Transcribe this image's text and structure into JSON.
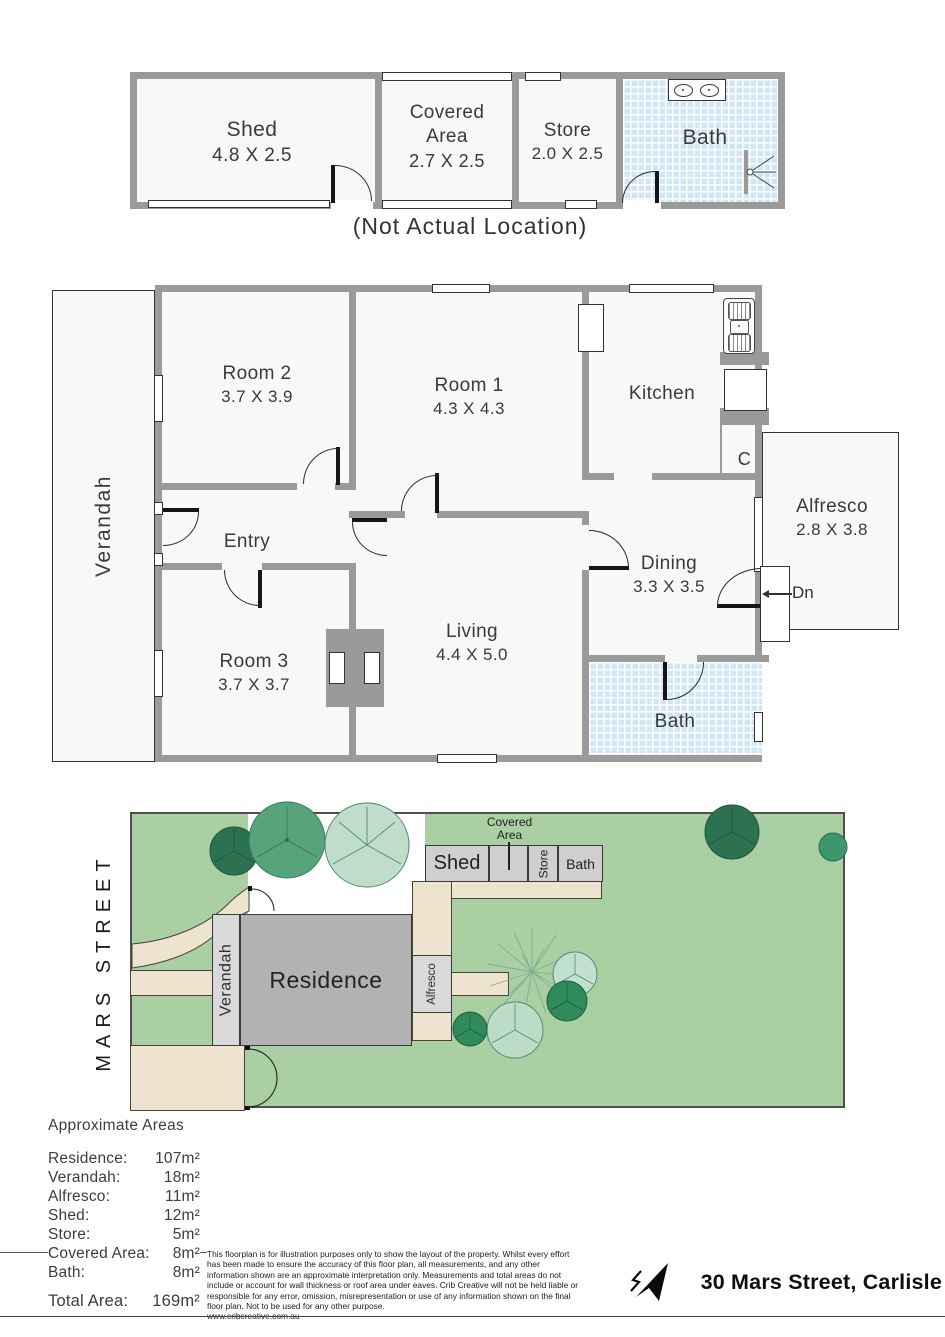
{
  "outbuilding": {
    "shed": {
      "name": "Shed",
      "dims": "4.8 X 2.5"
    },
    "covered": {
      "line1": "Covered",
      "line2": "Area",
      "dims": "2.7 X 2.5"
    },
    "store": {
      "name": "Store",
      "dims": "2.0 X 2.5"
    },
    "bath": {
      "name": "Bath"
    },
    "caption": "(Not Actual Location)"
  },
  "plan": {
    "verandah": "Verandah",
    "room2": {
      "name": "Room 2",
      "dims": "3.7 X 3.9"
    },
    "room1": {
      "name": "Room 1",
      "dims": "4.3 X 4.3"
    },
    "kitchen": {
      "name": "Kitchen"
    },
    "entry": {
      "name": "Entry"
    },
    "room3": {
      "name": "Room 3",
      "dims": "3.7 X 3.7"
    },
    "living": {
      "name": "Living",
      "dims": "4.4 X 5.0"
    },
    "dining": {
      "name": "Dining",
      "dims": "3.3 X 3.5"
    },
    "bath": {
      "name": "Bath"
    },
    "alfresco": {
      "name": "Alfresco",
      "dims": "2.8 X 3.8"
    },
    "cupboard": "C",
    "down": "Dn"
  },
  "site": {
    "street": "MARS STREET",
    "residence": "Residence",
    "verandah": "Verandah",
    "alfresco": "Alfresco",
    "shed": "Shed",
    "covered_line1": "Covered",
    "covered_line2": "Area",
    "store": "Store",
    "bath": "Bath"
  },
  "areas": {
    "title": "Approximate Areas",
    "items": [
      {
        "label": "Residence:",
        "value": "107m²"
      },
      {
        "label": "Verandah:",
        "value": "18m²"
      },
      {
        "label": "Alfresco:",
        "value": "11m²"
      },
      {
        "label": "Shed:",
        "value": "12m²"
      },
      {
        "label": "Store:",
        "value": "5m²"
      },
      {
        "label": "Covered Area:",
        "value": "8m²"
      },
      {
        "label": "Bath:",
        "value": "8m²"
      }
    ],
    "total_label": "Total Area:",
    "total_value": "169m²"
  },
  "footer": {
    "disclaimer": "This floorplan is for illustration purposes only to show the layout of the property. Whilst every effort has been made to ensure the accuracy of this floor plan, all measurements, and any other information shown are an approximate interpretation only. Measurements and total areas do not include or account for wall thickness or roof area under eaves. Crib Creative will not be held liable or responsible for any error, omission, misrepresentation or use of any information shown on the final floor plan. Not to be used for any other purpose.",
    "website": "www.cribcreative.com.au",
    "address": "30 Mars Street, Carlisle"
  },
  "colors": {
    "wall": "#9a9a9a",
    "room_fill": "#f8f8f6",
    "tile": "#cfe6f6",
    "lawn": "#aacfa3",
    "paving": "#eee3cf",
    "residence_fill": "#b2b2b2",
    "structure_fill": "#cfcfcf",
    "tree_dark": "#2c7251",
    "tree_medium": "#57a37c",
    "tree_light": "#c0ddcb"
  }
}
